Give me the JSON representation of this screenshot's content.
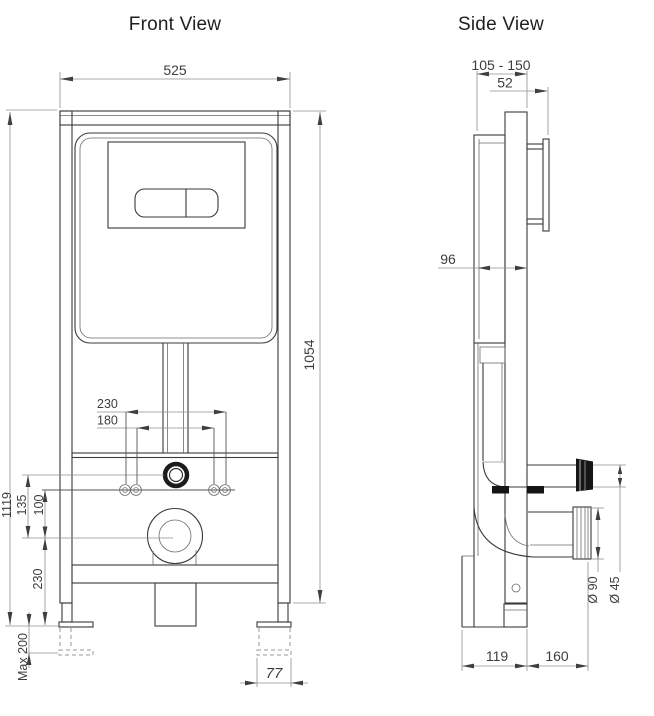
{
  "front_view": {
    "title": "Front View",
    "dims": {
      "width": "525",
      "frame_height": "1054",
      "overall_height": "1119",
      "bolt_spacing_outer": "230",
      "bolt_spacing_inner": "180",
      "inlet_to_outlet": "135",
      "bolts_to_outlet": "100",
      "outlet_to_base": "230",
      "feet_extension": "Max 200",
      "foot_plate_width": "77"
    }
  },
  "side_view": {
    "title": "Side View",
    "dims": {
      "depth_range": "105 - 150",
      "plate_offset": "52",
      "cistern_depth": "96",
      "waste_diameter": "Ø 90",
      "flush_diameter": "Ø 45",
      "base_rear": "119",
      "outlet_projection": "160"
    }
  },
  "colors": {
    "background": "#ffffff",
    "outline": "#3a3a3a",
    "dimension_lines": "#8f8f8f",
    "text": "#3d3d3d"
  }
}
